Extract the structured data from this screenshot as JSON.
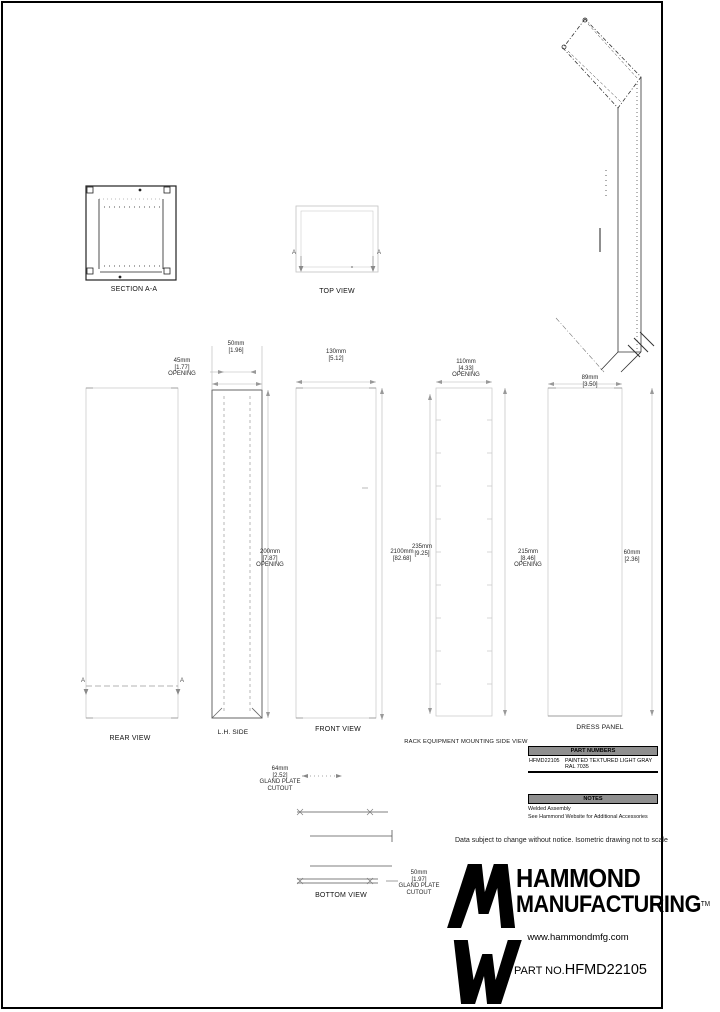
{
  "views": {
    "section_aa": "SECTION A-A",
    "top": "TOP VIEW",
    "rear": "REAR VIEW",
    "lh_side": "L.H. SIDE",
    "front": "FRONT VIEW",
    "rack_side": "RACK EQUIPMENT MOUNTING SIDE VIEW",
    "dress_panel": "DRESS PANEL",
    "bottom": "BOTTOM VIEW"
  },
  "markers": {
    "section_letter": "A"
  },
  "dims": {
    "t1": {
      "mm": "45mm",
      "in": "[1.77]",
      "note": "OPENING"
    },
    "t2": {
      "mm": "50mm",
      "in": "[1.96]"
    },
    "t3": {
      "mm": "130mm",
      "in": "[5.12]"
    },
    "t4": {
      "mm": "110mm",
      "in": "[4.33]",
      "note": "OPENING"
    },
    "t5": {
      "mm": "89mm",
      "in": "[3.50]"
    },
    "m1": {
      "mm": "200mm",
      "in": "[7.87]",
      "note": "OPENING"
    },
    "m2": {
      "mm": "2100mm",
      "in": "[82.68]"
    },
    "m2b": {
      "mm": "235mm",
      "in": "[9.25]"
    },
    "m3": {
      "mm": "215mm",
      "in": "[8.46]",
      "note": "OPENING"
    },
    "m4": {
      "mm": "60mm",
      "in": "[2.36]"
    },
    "b1": {
      "mm": "64mm",
      "in": "[2.52]",
      "note1": "GLAND PLATE",
      "note2": "CUTOUT"
    },
    "b2": {
      "mm": "50mm",
      "in": "[1.97]",
      "note1": "GLAND PLATE",
      "note2": "CUTOUT"
    }
  },
  "part_table": {
    "header": "PART NUMBERS",
    "part": "HFMD22105",
    "finish": "PAINTED TEXTURED LIGHT GRAY RAL 7035"
  },
  "notes": {
    "header": "NOTES",
    "line1": "Welded Assembly",
    "line2": "See Hammond Website for Additional Accessories"
  },
  "footer": {
    "disclaimer": "Data subject to change without notice. Isometric drawing not to scale",
    "brand_line1": "HAMMOND",
    "brand_line2": "MANUFACTURING",
    "brand_tm": "TM",
    "website": "www.hammondmfg.com",
    "part_no_label": "PART NO.",
    "part_number": "HFMD22105"
  }
}
